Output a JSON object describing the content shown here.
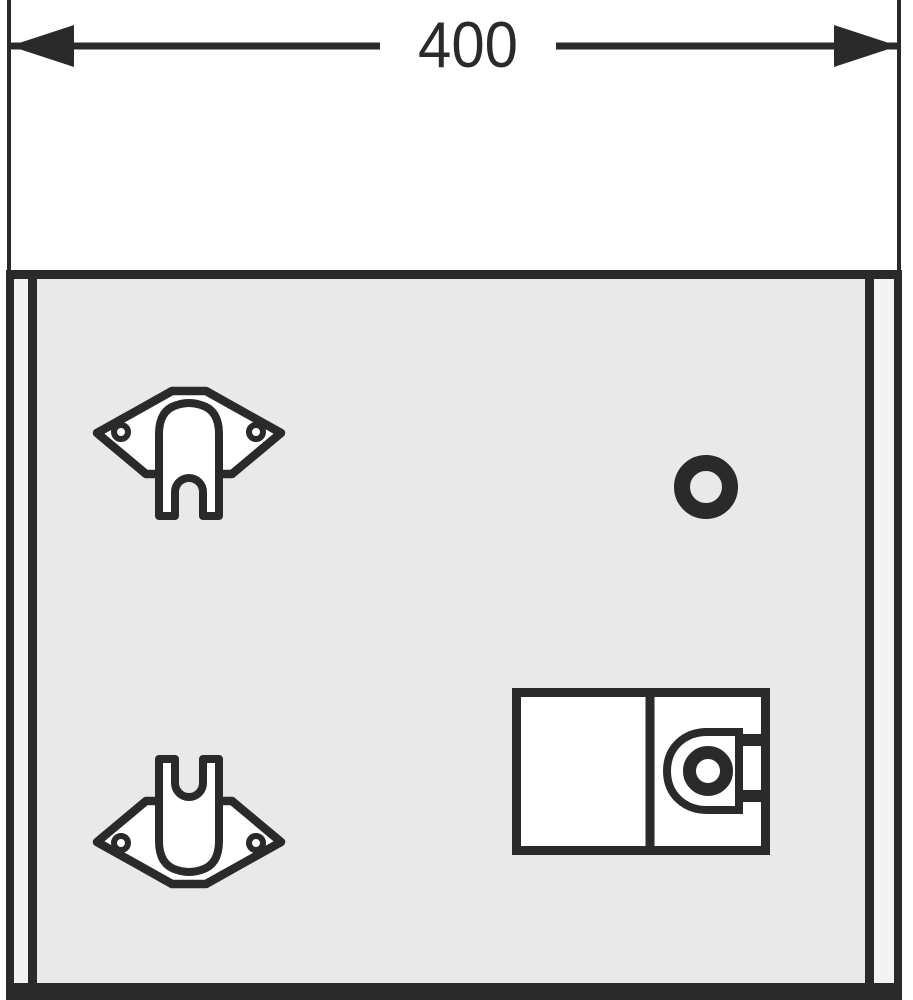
{
  "figure": {
    "type": "assembly-drawing",
    "view": "cabinet-back-panel"
  },
  "dimension": {
    "value": "400"
  },
  "colors": {
    "line": "#2a2a2a",
    "panel": "#e9e9e9",
    "panel_edge": "#f3f3f3",
    "part_fill": "#ffffff",
    "background": "#ffffff"
  },
  "parts": {
    "bracket_top": "wall-mounting-bracket",
    "bracket_bottom": "wall-mounting-bracket",
    "hole": "round-mounting-hole",
    "lock": "cam-lock-latch-unit"
  }
}
